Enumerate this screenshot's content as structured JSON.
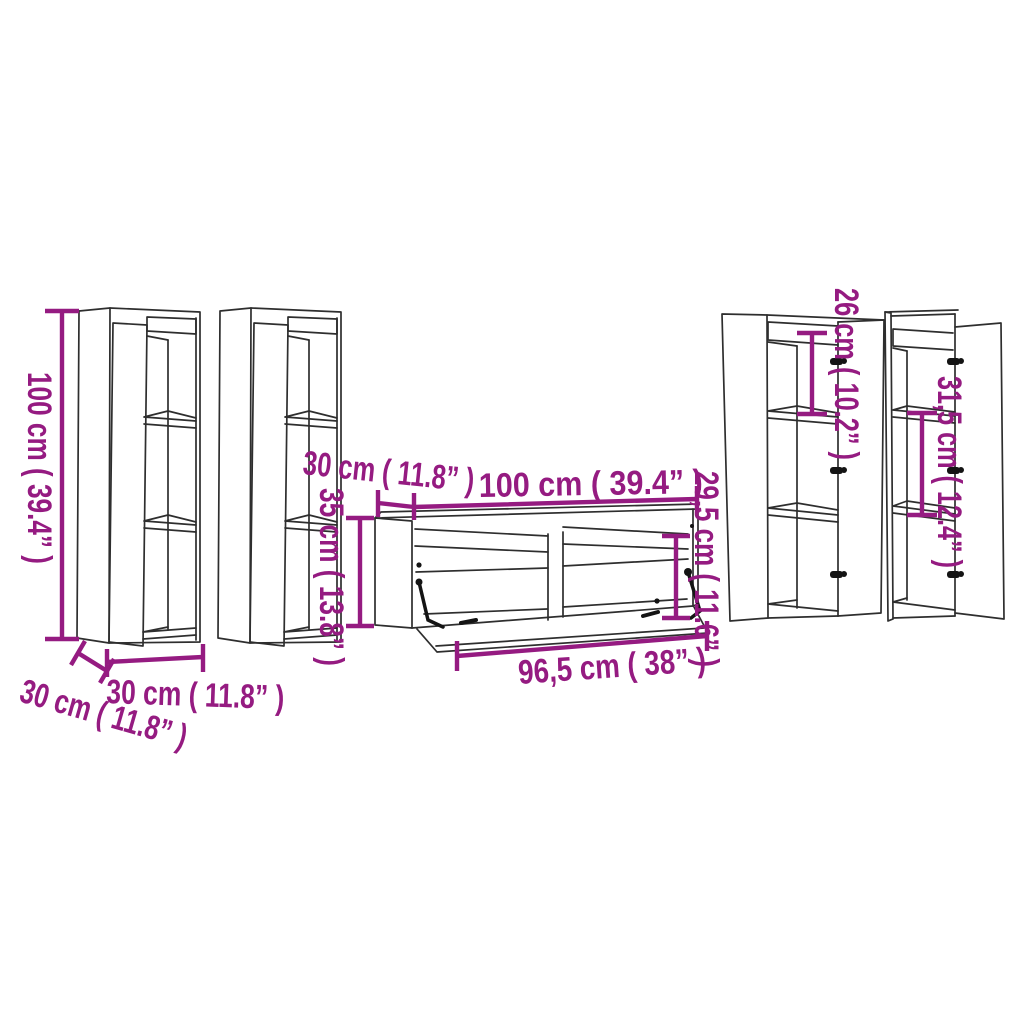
{
  "image": {
    "type": "product dimension line-drawing",
    "subject": "5-piece wall-mounted TV cabinet set with open doors and dimension callouts"
  },
  "colors": {
    "dimension_accent": "#951b81",
    "drawing_line": "#2e2e2e",
    "background": "#ffffff"
  },
  "dims": {
    "left_cabinet_height": "100 cm ( 39.4” )",
    "left_cabinet_depth": "30 cm ( 11.8” )",
    "left_cabinet_width": "30 cm ( 11.8” )",
    "tv_stand_height": "35 cm ( 13.8” )",
    "tv_stand_depth": "30 cm ( 11.8” )",
    "tv_stand_width": "100 cm ( 39.4” )",
    "tv_stand_inner_height": "29,5 cm ( 11.6” )",
    "tv_stand_inner_width": "96,5 cm ( 38” )",
    "right_cabinet_top_section_height": "26 cm ( 10.2” )",
    "right_cabinet_middle_section_height": "31,5 cm ( 12.4” )"
  }
}
